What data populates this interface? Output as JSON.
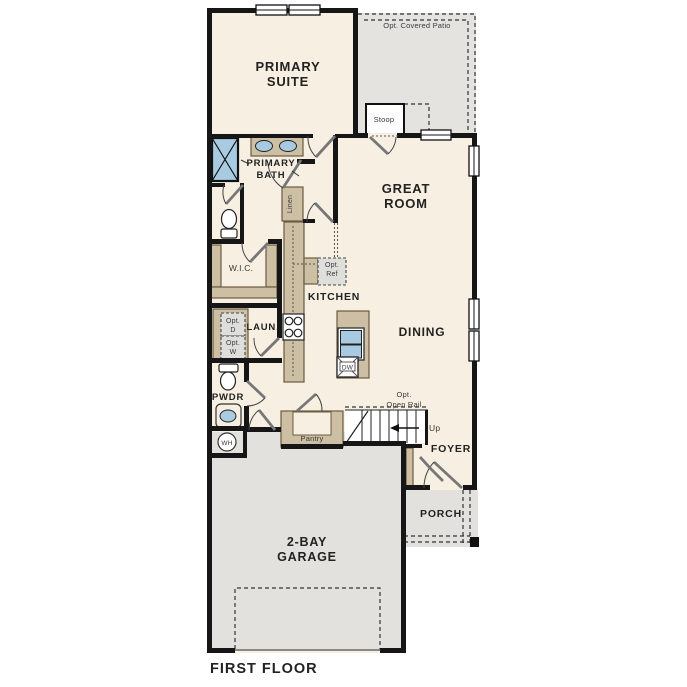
{
  "title": "FIRST FLOOR",
  "colors": {
    "wall": "#161616",
    "floor_cream": "#f7f0e2",
    "exterior_gray": "#e3e2df",
    "cabinet_tan": "#cdbfa3",
    "fixture_blue": "#a9cbe2",
    "label_text": "#222222"
  },
  "labels": {
    "primary_suite_1": "PRIMARY",
    "primary_suite_2": "SUITE",
    "primary_bath_1": "PRIMARY",
    "primary_bath_2": "BATH",
    "great_room_1": "GREAT",
    "great_room_2": "ROOM",
    "garage_1": "2-BAY",
    "garage_2": "GARAGE",
    "wic": "W.I.C.",
    "kitchen": "KITCHEN",
    "dining": "DINING",
    "laundry": "LAUN.",
    "powder": "PWDR",
    "pantry": "Pantry",
    "linen": "Linen",
    "foyer": "FOYER",
    "porch": "PORCH",
    "stoop": "Stoop",
    "opt_covered_patio": "Opt. Covered Patio",
    "opt_ref_1": "Opt.",
    "opt_ref_2": "Ref",
    "opt_d_1": "Opt.",
    "opt_d_2": "D",
    "opt_w_1": "Opt.",
    "opt_w_2": "W",
    "opt_open_rail_1": "Opt.",
    "opt_open_rail_2": "Open Rail",
    "up": "Up",
    "wh": "WH",
    "dw": "DW",
    "first_floor": "FIRST FLOOR"
  }
}
